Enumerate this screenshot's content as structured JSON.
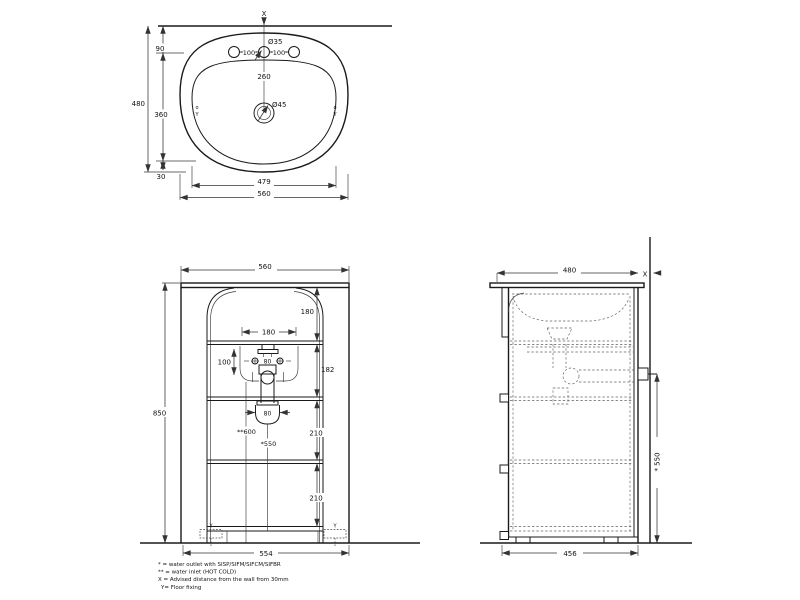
{
  "colors": {
    "background": "#ffffff",
    "line": "#1a1a1a",
    "dim": "#333333"
  },
  "top_view": {
    "wall_mark": "X",
    "tap_hole_dia": "Ø35",
    "tap_pitch_left": "100",
    "tap_pitch_right": "100",
    "drain_offset": "260",
    "drain_dia": "Ø45",
    "depth_total": "480",
    "depth_rear": "90",
    "depth_mid": "360",
    "depth_front": "30",
    "rim_width": "479",
    "width_total": "560",
    "fix_mark_circle": "o",
    "fix_mark_y": "Y"
  },
  "front_view": {
    "width_top": "560",
    "height_total": "850",
    "apron_height": "180",
    "bracket_pitch": "180",
    "inlet_drop": "100",
    "inlet_pitch": "80",
    "trap_section_height": "182",
    "trap_width": "80",
    "inlet_floor_height": "**600",
    "outlet_floor_height": "*550",
    "shelf_gap_upper": "210",
    "shelf_gap_lower": "210",
    "base_width": "554",
    "floor_fix_mark": "Y"
  },
  "side_view": {
    "depth_total": "480",
    "wall_mark": "X",
    "fixing_height": "* 550",
    "base_depth": "456"
  },
  "legend": {
    "line1": "* = water outlet with SISP/SIFM/SIFCM/SIFBR",
    "line2": "** = water inlet (HOT COLD)",
    "line3": "X = Advised distance from the wall from 30mm",
    "line4": "Y= Floor fixing"
  }
}
